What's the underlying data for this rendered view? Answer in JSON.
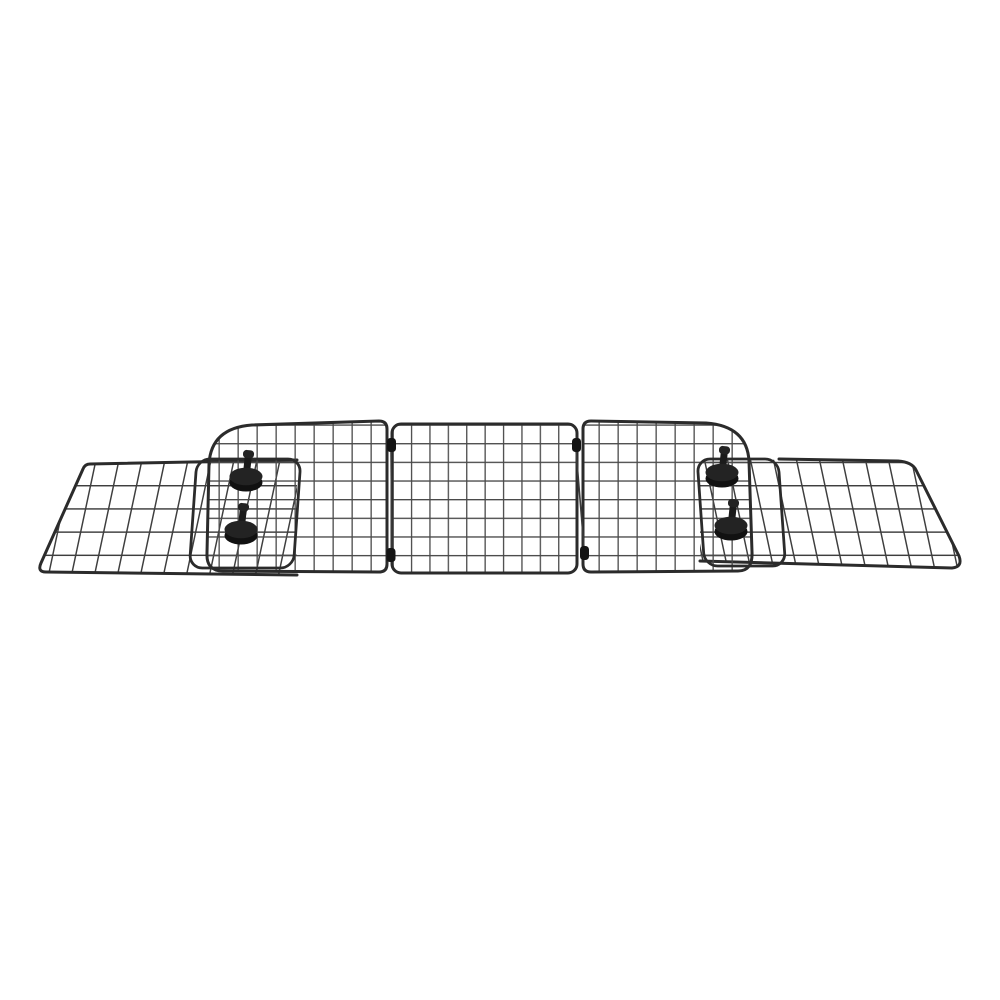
{
  "image": {
    "alt": "Black adjustable wire mesh vehicle pet barrier: three hinged grid panels with two angled slide-out extension panels, secured by four black locking knobs, on a plain white background",
    "background": "#ffffff"
  },
  "product": {
    "name": "adjustable-wire-mesh-pet-barrier",
    "panel_count": 5,
    "knob_count": 4,
    "hinge_count": 4,
    "panels": [
      "left-extension-panel",
      "left-main-panel",
      "center-panel",
      "right-main-panel",
      "right-extension-panel"
    ]
  },
  "colors": {
    "background": "#ffffff",
    "frame": "#2b2b2b",
    "grid_wire": "#4a4a4a",
    "extension_wire": "#3e3e3e",
    "knob_body": "#232323",
    "knob_rim": "#111111",
    "knob_stem": "#1b1b1b",
    "hinge": "#141414",
    "rod": "#3a3a3a"
  }
}
